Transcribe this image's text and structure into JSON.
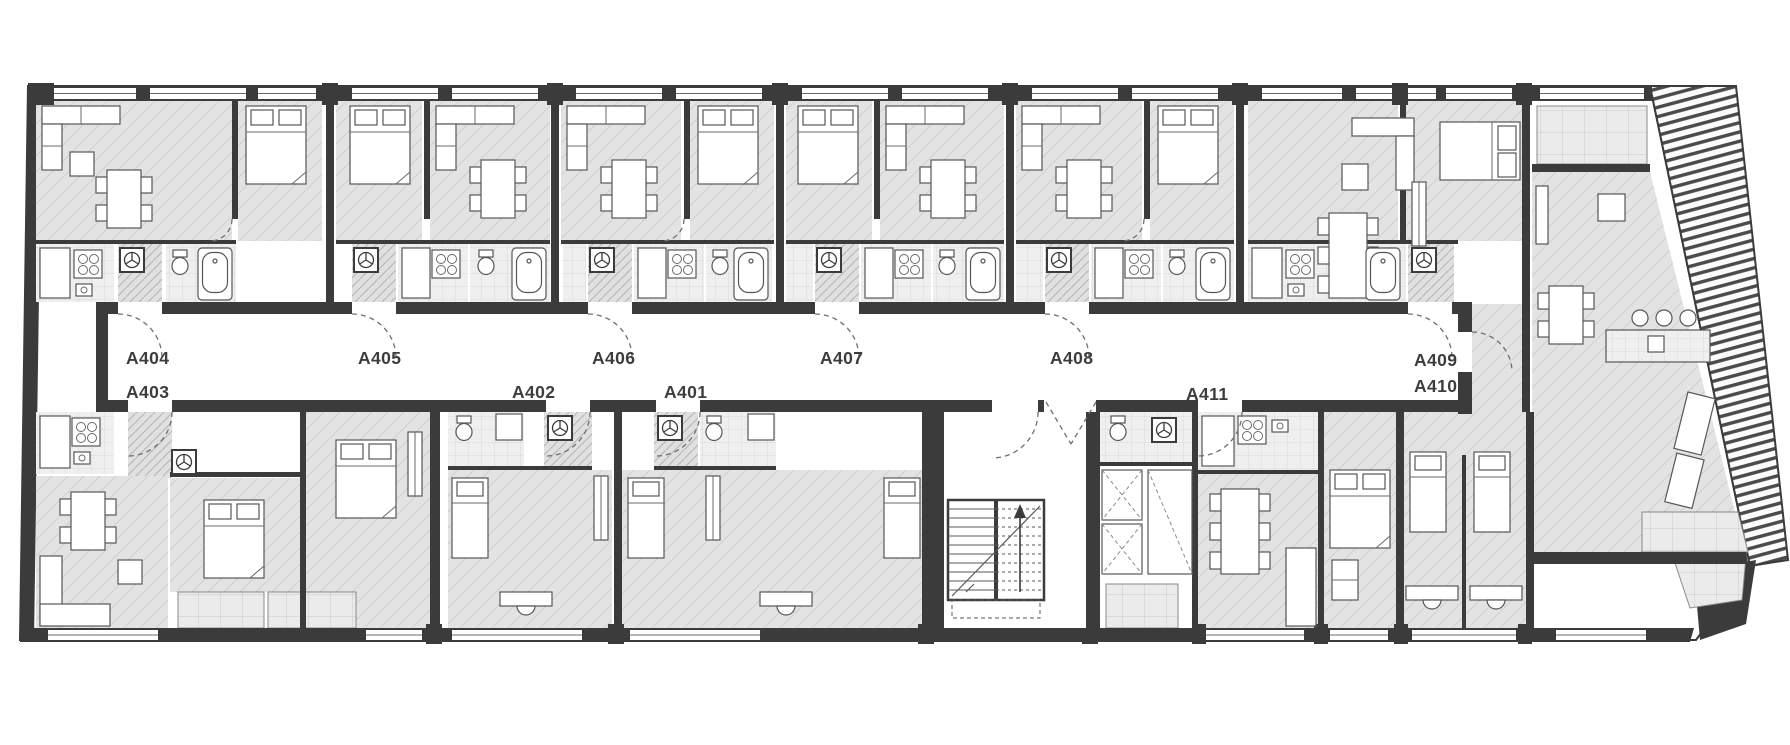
{
  "plan_type": "apartment-building-floor-plan",
  "units": [
    {
      "id": "a404",
      "label": "A404"
    },
    {
      "id": "a405",
      "label": "A405"
    },
    {
      "id": "a406",
      "label": "A406"
    },
    {
      "id": "a407",
      "label": "A407"
    },
    {
      "id": "a408",
      "label": "A408"
    },
    {
      "id": "a409",
      "label": "A409"
    },
    {
      "id": "a403",
      "label": "A403"
    },
    {
      "id": "a402",
      "label": "A402"
    },
    {
      "id": "a401",
      "label": "A401"
    },
    {
      "id": "a411",
      "label": "A411"
    },
    {
      "id": "a410",
      "label": "A410"
    }
  ],
  "icons": {
    "ventilation": "fan-icon",
    "stairs_direction": "up-arrow-icon"
  },
  "colors": {
    "wall": "#3b3b3b",
    "room_fill": "#e3e3e3",
    "wet_room_fill": "#efefef",
    "balcony_fill": "#ebebeb",
    "corridor_fill": "#ffffff",
    "label_text": "#3d3d3d"
  }
}
